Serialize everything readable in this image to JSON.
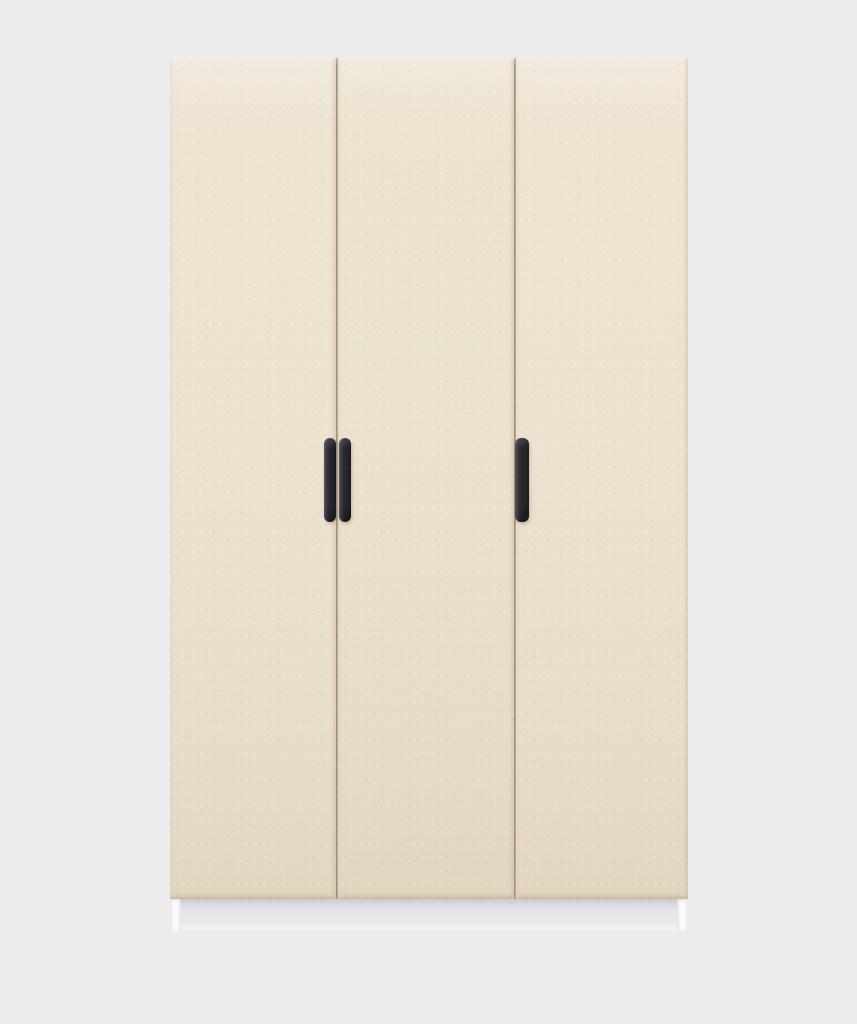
{
  "scene": {
    "type": "product-render",
    "description": "Three-door wardrobe in cream with black vertical handles and a white plinth base on a plain light-grey studio background",
    "background_color": "#ececed"
  },
  "wardrobe": {
    "label": "three-door-wardrobe",
    "door_count": 3,
    "handle_count": 3,
    "doors": {
      "left": {
        "color": "#ece2cf"
      },
      "middle": {
        "color": "#ebe1cd"
      },
      "right": {
        "color": "#ece2cf"
      }
    },
    "gap_color": "#b49c7c",
    "handles": {
      "color": "#26282e",
      "pair_left": {
        "position": "left gap, mounted on left door edge"
      },
      "pair_right": {
        "position": "left gap, mounted on middle door edge"
      },
      "single": {
        "position": "right gap, mounted on right door edge"
      }
    },
    "plinth": {
      "foot_color": "#f9fafb",
      "recess_color": "#e3e5e8"
    }
  }
}
